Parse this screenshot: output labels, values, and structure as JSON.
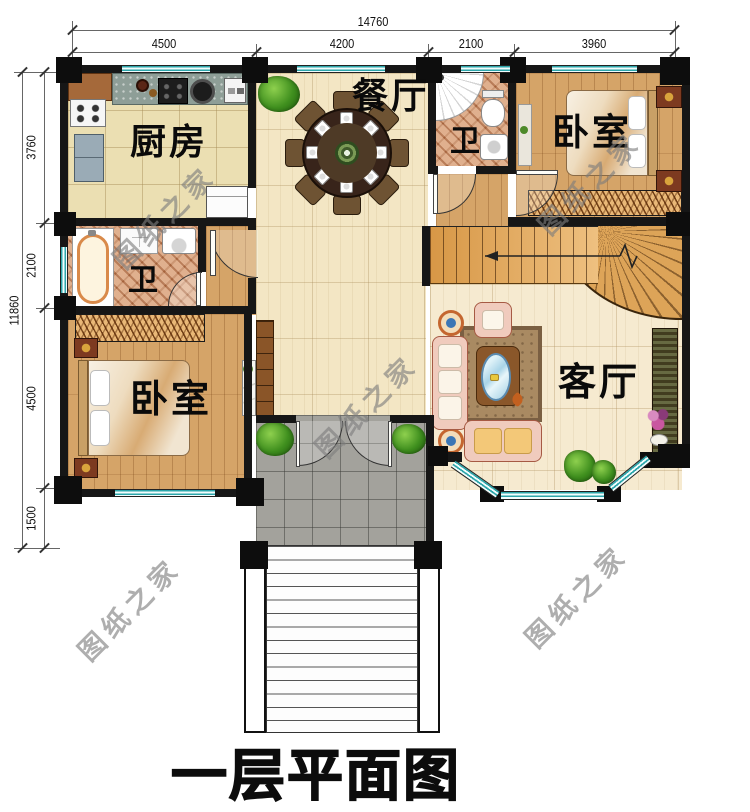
{
  "title": "一层平面图",
  "watermark": "图纸之家",
  "dims_top": {
    "total": "14760",
    "segs": [
      "4500",
      "4200",
      "2100",
      "3960"
    ]
  },
  "dims_left": {
    "total": "11860",
    "segs": [
      "3760",
      "2100",
      "4500",
      "1500"
    ]
  },
  "rooms": {
    "dining": "餐厅",
    "kitchen": "厨房",
    "bath_top": "卫",
    "bedroom_top": "卧室",
    "bath_left": "卫",
    "bedroom_bottom": "卧室",
    "living": "客厅"
  },
  "colors": {
    "wall": "#161616",
    "window_teal": "#2da6ab",
    "wood_floor": "#d5a468",
    "pale_floor": "#f3e6c4",
    "kitchen_tile": "#ebdfb2",
    "bath_tile": "#c8825a",
    "porch_gray": "#a3a29c",
    "stair_wood": "#dda458"
  }
}
